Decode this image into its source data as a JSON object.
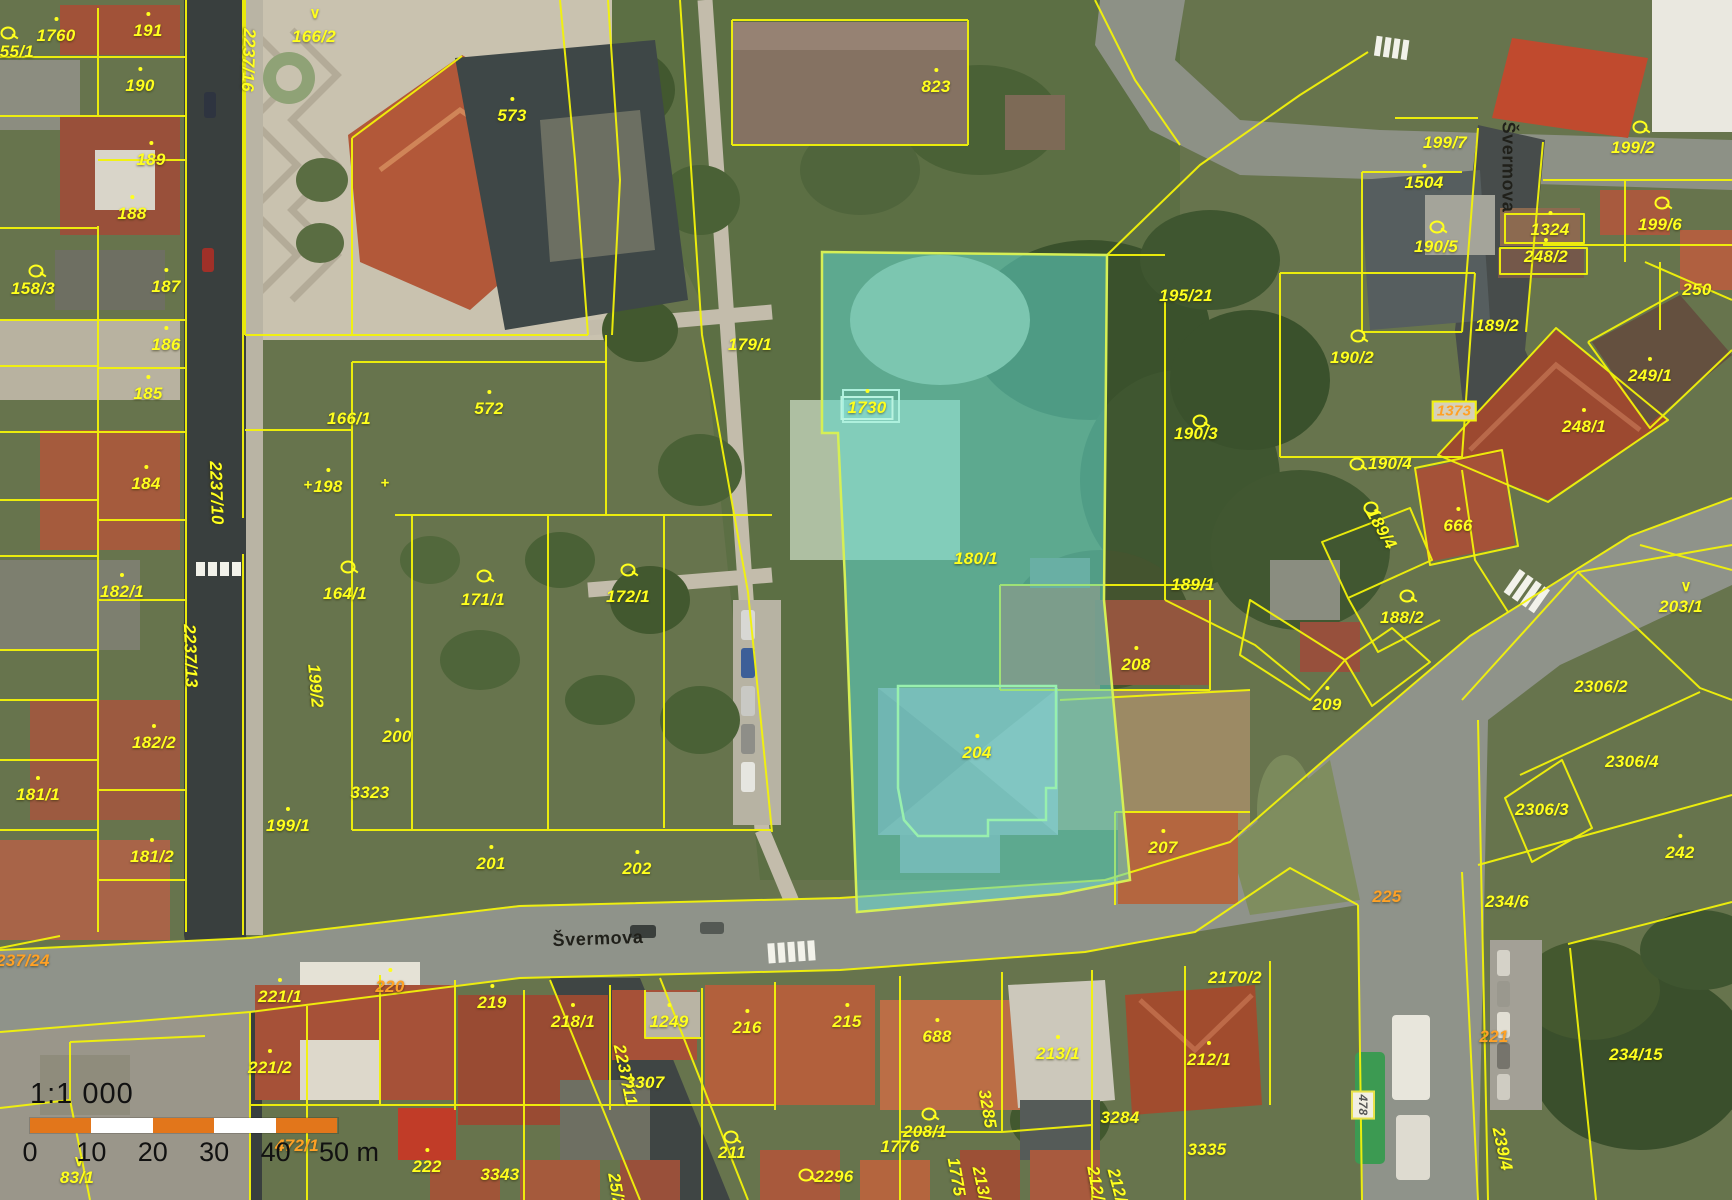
{
  "map_title": "Cadastral map with orthophoto",
  "colors": {
    "parcel_line": "#f2f20a",
    "parcel_label": "#ffff1e",
    "secondary_label": "#ffa126",
    "street_label": "#20201a",
    "highlight_fill": "rgba(95,216,205,0.55)",
    "highlight_stroke": "#d6ef55",
    "inner_building_stroke": "#98f0ae",
    "scale_bar_orange": "#e2761b"
  },
  "highlight": {
    "parcel": "180/1",
    "building_parcel": "204",
    "boxed_label": "1730"
  },
  "selected_label": "1373",
  "street_labels": [
    {
      "text": "Švermova",
      "x": 598,
      "y": 939,
      "rot": -2
    },
    {
      "text": "Švermova",
      "x": 1508,
      "y": 167,
      "rot": 90
    }
  ],
  "scale_bar": {
    "ratio": "1:1 000",
    "tick_labels": [
      "0",
      "10",
      "20",
      "30",
      "40",
      "50 m"
    ],
    "segment_colors": [
      "#e2761b",
      "#ffffff",
      "#e2761b",
      "#ffffff",
      "#e2761b"
    ]
  },
  "parcel_labels": [
    {
      "t": "1760",
      "x": 56,
      "y": 36,
      "dot": 1
    },
    {
      "t": "155/1",
      "x": 12,
      "y": 52
    },
    {
      "t": "191",
      "x": 148,
      "y": 31,
      "dot": 1
    },
    {
      "t": "190",
      "x": 140,
      "y": 86,
      "dot": 1
    },
    {
      "t": "189",
      "x": 151,
      "y": 160,
      "dot": 1
    },
    {
      "t": "188",
      "x": 132,
      "y": 214,
      "dot": 1
    },
    {
      "t": "187",
      "x": 166,
      "y": 287,
      "dot": 1
    },
    {
      "t": "158/3",
      "x": 33,
      "y": 289
    },
    {
      "t": "166/2",
      "x": 314,
      "y": 37
    },
    {
      "t": "2237/16",
      "x": 248,
      "y": 60,
      "rot": 92
    },
    {
      "t": "573",
      "x": 512,
      "y": 116,
      "dot": 1
    },
    {
      "t": "823",
      "x": 936,
      "y": 87,
      "dot": 1
    },
    {
      "t": "195/21",
      "x": 1186,
      "y": 296
    },
    {
      "t": "199/7",
      "x": 1445,
      "y": 143
    },
    {
      "t": "1504",
      "x": 1424,
      "y": 183,
      "dot": 1
    },
    {
      "t": "199/2",
      "x": 1633,
      "y": 148
    },
    {
      "t": "199/6",
      "x": 1660,
      "y": 225
    },
    {
      "t": "1324",
      "x": 1550,
      "y": 230,
      "dot": 1
    },
    {
      "t": "248/2",
      "x": 1546,
      "y": 257,
      "dot": 1
    },
    {
      "t": "190/5",
      "x": 1436,
      "y": 247
    },
    {
      "t": "250",
      "x": 1697,
      "y": 290
    },
    {
      "t": "189/2",
      "x": 1497,
      "y": 326
    },
    {
      "t": "190/2",
      "x": 1352,
      "y": 358
    },
    {
      "t": "190/3",
      "x": 1196,
      "y": 434
    },
    {
      "t": "190/4",
      "x": 1390,
      "y": 464
    },
    {
      "t": "189/4",
      "x": 1381,
      "y": 529,
      "rot": 60
    },
    {
      "t": "666",
      "x": 1458,
      "y": 526,
      "dot": 1
    },
    {
      "t": "249/1",
      "x": 1650,
      "y": 376,
      "dot": 1
    },
    {
      "t": "248/1",
      "x": 1584,
      "y": 427,
      "dot": 1
    },
    {
      "t": "179/1",
      "x": 750,
      "y": 345
    },
    {
      "t": "572",
      "x": 489,
      "y": 409,
      "dot": 1
    },
    {
      "t": "166/1",
      "x": 349,
      "y": 419
    },
    {
      "t": "198",
      "x": 328,
      "y": 487,
      "dot": 1
    },
    {
      "t": "164/1",
      "x": 345,
      "y": 594
    },
    {
      "t": "171/1",
      "x": 483,
      "y": 600
    },
    {
      "t": "172/1",
      "x": 628,
      "y": 597
    },
    {
      "t": "180/1",
      "x": 976,
      "y": 559
    },
    {
      "t": "1730",
      "x": 867,
      "y": 408,
      "box": "cyan",
      "dot": 1
    },
    {
      "t": "186",
      "x": 166,
      "y": 345,
      "dot": 1
    },
    {
      "t": "185",
      "x": 148,
      "y": 394,
      "dot": 1
    },
    {
      "t": "184",
      "x": 146,
      "y": 484,
      "dot": 1
    },
    {
      "t": "182/1",
      "x": 122,
      "y": 592,
      "dot": 1
    },
    {
      "t": "182/2",
      "x": 154,
      "y": 743,
      "dot": 1
    },
    {
      "t": "181/1",
      "x": 38,
      "y": 795,
      "dot": 1
    },
    {
      "t": "181/2",
      "x": 152,
      "y": 857,
      "dot": 1
    },
    {
      "t": "2237/10",
      "x": 216,
      "y": 493,
      "rot": 88
    },
    {
      "t": "2237/13",
      "x": 190,
      "y": 656,
      "rot": 88
    },
    {
      "t": "199/2",
      "x": 315,
      "y": 686,
      "rot": 85
    },
    {
      "t": "200",
      "x": 397,
      "y": 737,
      "dot": 1
    },
    {
      "t": "3323",
      "x": 370,
      "y": 793
    },
    {
      "t": "199/1",
      "x": 288,
      "y": 826,
      "dot": 1
    },
    {
      "t": "201",
      "x": 491,
      "y": 864,
      "dot": 1
    },
    {
      "t": "202",
      "x": 637,
      "y": 869,
      "dot": 1
    },
    {
      "t": "189/1",
      "x": 1193,
      "y": 585
    },
    {
      "t": "188/2",
      "x": 1402,
      "y": 618
    },
    {
      "t": "208",
      "x": 1136,
      "y": 665,
      "dot": 1
    },
    {
      "t": "209",
      "x": 1327,
      "y": 705,
      "dot": 1
    },
    {
      "t": "207",
      "x": 1163,
      "y": 848,
      "dot": 1
    },
    {
      "t": "204",
      "x": 977,
      "y": 753,
      "dot": 1
    },
    {
      "t": "203/1",
      "x": 1681,
      "y": 607
    },
    {
      "t": "2306/2",
      "x": 1601,
      "y": 687
    },
    {
      "t": "2306/4",
      "x": 1632,
      "y": 762
    },
    {
      "t": "2306/3",
      "x": 1542,
      "y": 810
    },
    {
      "t": "242",
      "x": 1680,
      "y": 853,
      "dot": 1
    },
    {
      "t": "2170/2",
      "x": 1235,
      "y": 978
    },
    {
      "t": "234/6",
      "x": 1507,
      "y": 902
    },
    {
      "t": "234/15",
      "x": 1636,
      "y": 1055
    },
    {
      "t": "239/4",
      "x": 1502,
      "y": 1149,
      "rot": 78
    },
    {
      "t": "2237/11",
      "x": 625,
      "y": 1075,
      "rot": 78
    },
    {
      "t": "219",
      "x": 492,
      "y": 1003,
      "dot": 1
    },
    {
      "t": "218/1",
      "x": 573,
      "y": 1022,
      "dot": 1
    },
    {
      "t": "1249",
      "x": 669,
      "y": 1022,
      "dot": 1
    },
    {
      "t": "216",
      "x": 747,
      "y": 1028,
      "dot": 1
    },
    {
      "t": "215",
      "x": 847,
      "y": 1022,
      "dot": 1
    },
    {
      "t": "688",
      "x": 937,
      "y": 1037,
      "dot": 1
    },
    {
      "t": "213/1",
      "x": 1058,
      "y": 1054,
      "dot": 1
    },
    {
      "t": "212/1",
      "x": 1209,
      "y": 1060,
      "dot": 1
    },
    {
      "t": "3307",
      "x": 645,
      "y": 1083
    },
    {
      "t": "222",
      "x": 427,
      "y": 1167,
      "dot": 1
    },
    {
      "t": "3343",
      "x": 500,
      "y": 1175
    },
    {
      "t": "211",
      "x": 732,
      "y": 1153
    },
    {
      "t": "2296",
      "x": 834,
      "y": 1177
    },
    {
      "t": "208/1",
      "x": 925,
      "y": 1132
    },
    {
      "t": "1776",
      "x": 900,
      "y": 1147
    },
    {
      "t": "1775",
      "x": 956,
      "y": 1177,
      "rot": 80
    },
    {
      "t": "213/2",
      "x": 982,
      "y": 1188,
      "rot": 78
    },
    {
      "t": "3285",
      "x": 987,
      "y": 1109,
      "rot": 80
    },
    {
      "t": "3284",
      "x": 1120,
      "y": 1118
    },
    {
      "t": "3335",
      "x": 1207,
      "y": 1150
    },
    {
      "t": "212/4",
      "x": 1096,
      "y": 1188,
      "rot": 80
    },
    {
      "t": "212/5",
      "x": 1118,
      "y": 1190,
      "rot": 75
    },
    {
      "t": "25/2",
      "x": 616,
      "y": 1190,
      "rot": 80
    },
    {
      "t": "83/1",
      "x": 77,
      "y": 1178
    },
    {
      "t": "2237/24",
      "x": 18,
      "y": 961,
      "c": "o"
    },
    {
      "t": "221/1",
      "x": 280,
      "y": 997,
      "dot": 1
    },
    {
      "t": "221/2",
      "x": 270,
      "y": 1068,
      "dot": 1
    },
    {
      "t": "220",
      "x": 390,
      "y": 987,
      "c": "o",
      "dot": 1
    },
    {
      "t": "472/1",
      "x": 297,
      "y": 1146,
      "c": "o"
    },
    {
      "t": "225",
      "x": 1387,
      "y": 897,
      "c": "o"
    },
    {
      "t": "221",
      "x": 1494,
      "y": 1037,
      "c": "o"
    },
    {
      "t": "1373",
      "x": 1454,
      "y": 411,
      "box": "sel",
      "c": "o"
    },
    {
      "t": "478",
      "x": 1363,
      "y": 1105,
      "rot": 90,
      "box": "white"
    }
  ],
  "symbols": [
    {
      "k": "circle",
      "x": 8,
      "y": 33
    },
    {
      "k": "circle",
      "x": 36,
      "y": 271
    },
    {
      "k": "v",
      "x": 315,
      "y": 13
    },
    {
      "k": "cross",
      "x": 308,
      "y": 485
    },
    {
      "k": "cross",
      "x": 385,
      "y": 483
    },
    {
      "k": "circle",
      "x": 348,
      "y": 567
    },
    {
      "k": "circle",
      "x": 484,
      "y": 576
    },
    {
      "k": "circle",
      "x": 628,
      "y": 570
    },
    {
      "k": "circle",
      "x": 1200,
      "y": 421
    },
    {
      "k": "circle",
      "x": 1358,
      "y": 336
    },
    {
      "k": "circle",
      "x": 1357,
      "y": 464
    },
    {
      "k": "circle",
      "x": 1371,
      "y": 508
    },
    {
      "k": "circle",
      "x": 1407,
      "y": 596
    },
    {
      "k": "circle",
      "x": 1640,
      "y": 127
    },
    {
      "k": "circle",
      "x": 1662,
      "y": 203
    },
    {
      "k": "circle",
      "x": 1437,
      "y": 227
    },
    {
      "k": "v",
      "x": 1686,
      "y": 586
    },
    {
      "k": "v",
      "x": 79,
      "y": 1161
    },
    {
      "k": "circle",
      "x": 731,
      "y": 1137
    },
    {
      "k": "circle",
      "x": 806,
      "y": 1175
    },
    {
      "k": "circle",
      "x": 929,
      "y": 1114
    }
  ]
}
